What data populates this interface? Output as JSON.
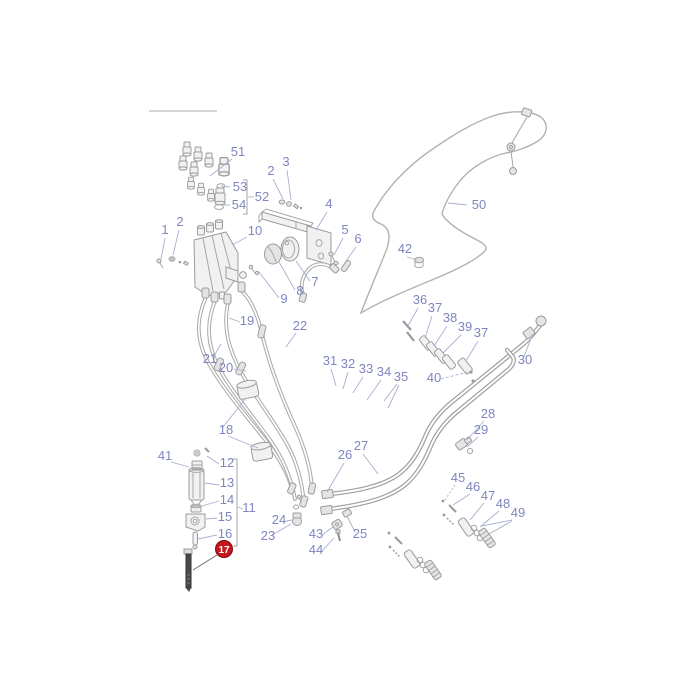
{
  "page": {
    "width": 700,
    "height": 700,
    "background": "#ffffff"
  },
  "diagram": {
    "kind": "exploded-parts-diagram",
    "subject": "Hydraulic control valve, hoses and pipework assembly",
    "label_color": "#7f85bf",
    "line_color": "#a6a6a6",
    "highlight": {
      "part_number": "17",
      "badge_background": "#c4161c",
      "badge_border": "#7e0d10",
      "badge_text_color": "#ffffff"
    }
  },
  "labels": [
    {
      "text": "1"
    },
    {
      "text": "2"
    },
    {
      "text": "2"
    },
    {
      "text": "3"
    },
    {
      "text": "4"
    },
    {
      "text": "5"
    },
    {
      "text": "6"
    },
    {
      "text": "7"
    },
    {
      "text": "8"
    },
    {
      "text": "9"
    },
    {
      "text": "10"
    },
    {
      "text": "11"
    },
    {
      "text": "12"
    },
    {
      "text": "13"
    },
    {
      "text": "14"
    },
    {
      "text": "15"
    },
    {
      "text": "16"
    },
    {
      "text": "17",
      "highlighted": true
    },
    {
      "text": "18"
    },
    {
      "text": "19"
    },
    {
      "text": "20"
    },
    {
      "text": "21"
    },
    {
      "text": "22"
    },
    {
      "text": "23"
    },
    {
      "text": "24"
    },
    {
      "text": "25"
    },
    {
      "text": "26"
    },
    {
      "text": "27"
    },
    {
      "text": "28"
    },
    {
      "text": "29"
    },
    {
      "text": "30"
    },
    {
      "text": "31"
    },
    {
      "text": "32"
    },
    {
      "text": "33"
    },
    {
      "text": "34"
    },
    {
      "text": "35"
    },
    {
      "text": "36"
    },
    {
      "text": "37"
    },
    {
      "text": "38"
    },
    {
      "text": "39"
    },
    {
      "text": "40"
    },
    {
      "text": "41"
    },
    {
      "text": "42"
    },
    {
      "text": "43"
    },
    {
      "text": "44"
    },
    {
      "text": "45"
    },
    {
      "text": "46"
    },
    {
      "text": "47"
    },
    {
      "text": "48"
    },
    {
      "text": "49"
    },
    {
      "text": "50"
    },
    {
      "text": "51"
    },
    {
      "text": "52"
    },
    {
      "text": "53"
    },
    {
      "text": "54"
    },
    {
      "text": "37"
    }
  ]
}
